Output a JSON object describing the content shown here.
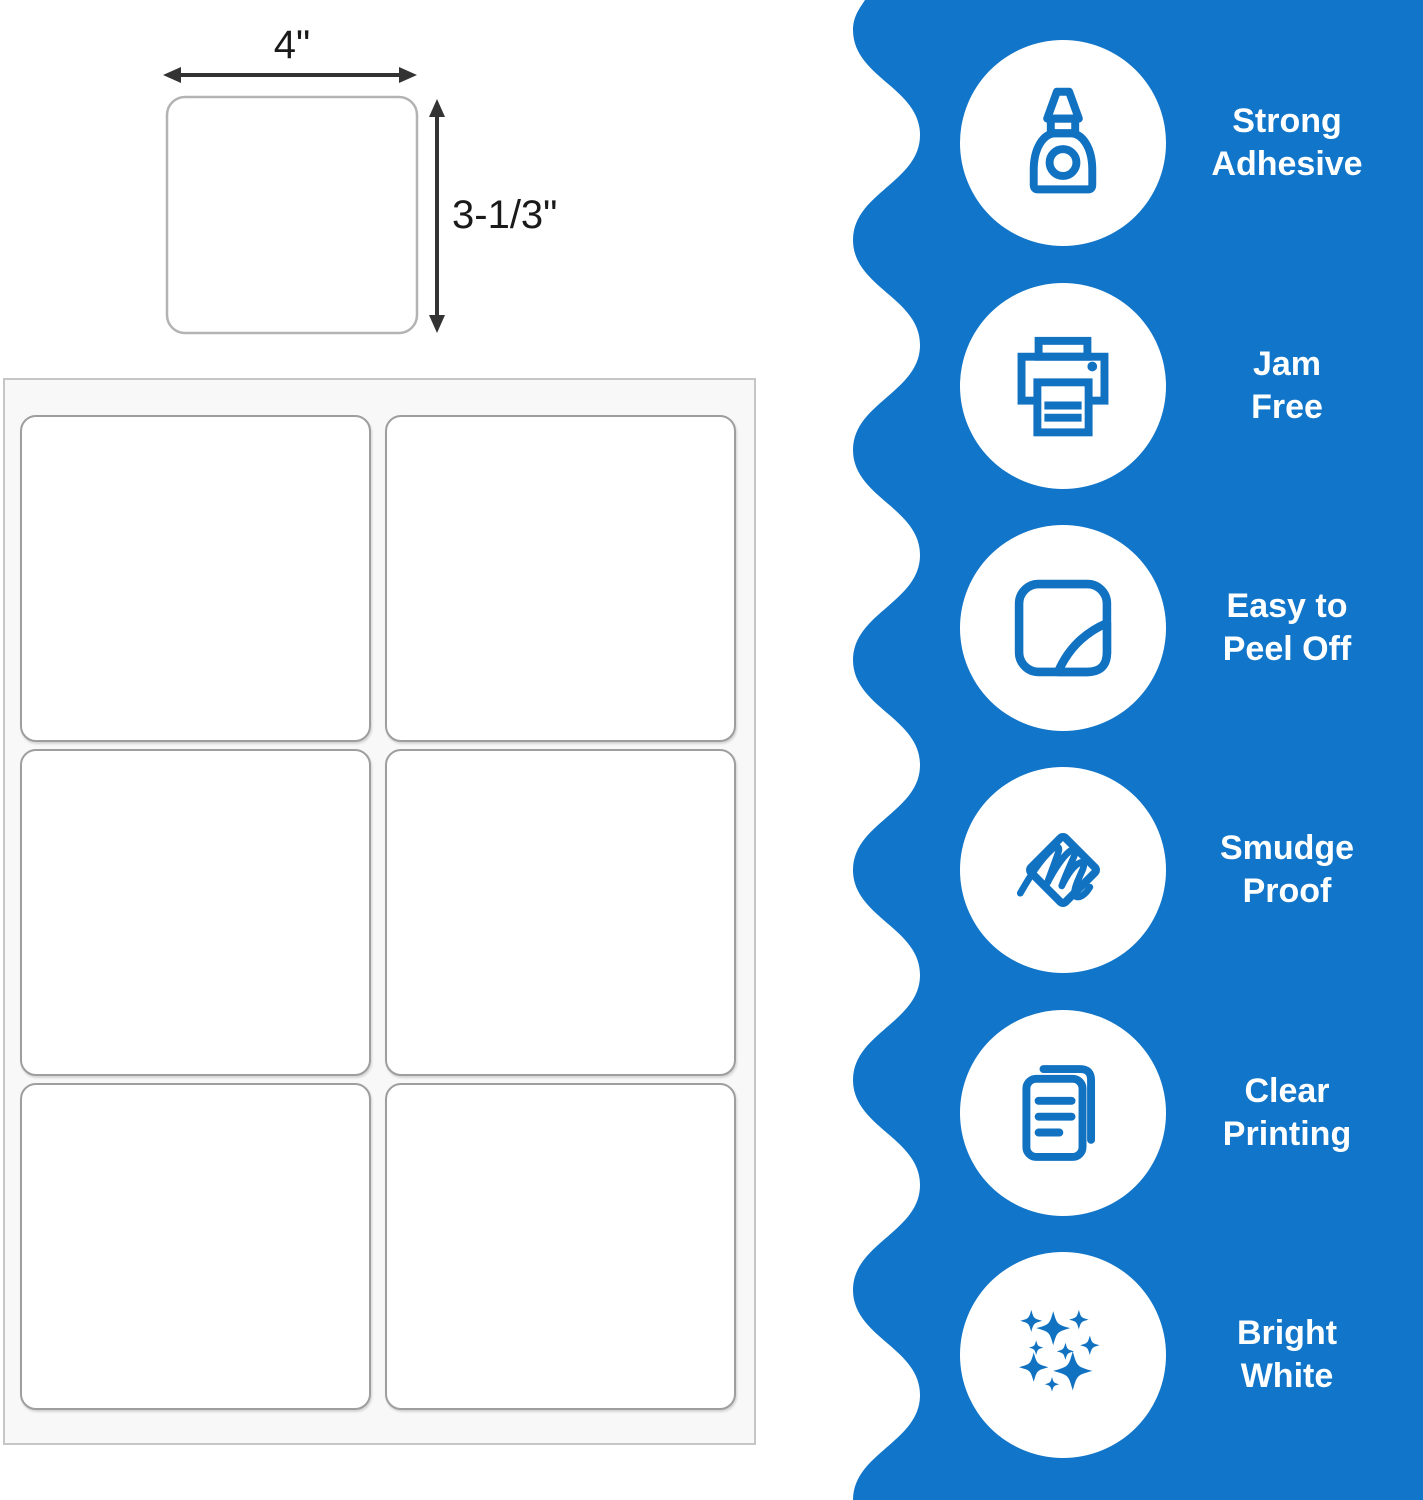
{
  "colors": {
    "panel_blue": "#1175C9",
    "icon_blue": "#1172C2",
    "arrow_gray": "#333333",
    "label_border_gray": "#9e9e9e"
  },
  "dimension_diagram": {
    "width_label": "4\"",
    "height_label": "3-1/3\""
  },
  "label_sheet": {
    "columns": 2,
    "rows": 3,
    "labels_visible": 6
  },
  "features": [
    {
      "icon": "glue-bottle-icon",
      "line1": "Strong",
      "line2": "Adhesive"
    },
    {
      "icon": "printer-icon",
      "line1": "Jam",
      "line2": "Free"
    },
    {
      "icon": "peel-off-sticker-icon",
      "line1": "Easy to",
      "line2": "Peel Off"
    },
    {
      "icon": "smudge-wipe-hand-icon",
      "line1": "Smudge",
      "line2": "Proof"
    },
    {
      "icon": "printed-documents-icon",
      "line1": "Clear",
      "line2": "Printing"
    },
    {
      "icon": "sparkles-icon",
      "line1": "Bright",
      "line2": "White"
    }
  ]
}
